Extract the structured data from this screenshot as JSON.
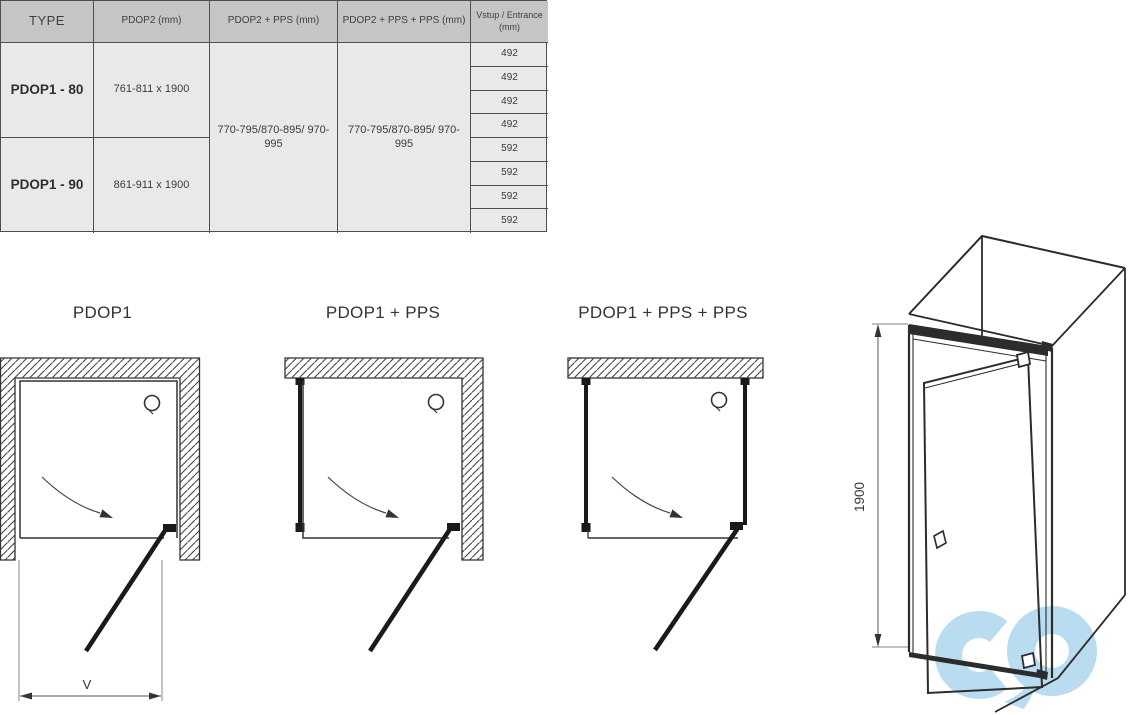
{
  "table": {
    "headers": {
      "type": "TYPE",
      "pdop2": "PDOP2 (mm)",
      "pdop2_pps": "PDOP2 + PPS (mm)",
      "pdop2_pps_pps": "PDOP2 + PPS + PPS (mm)",
      "entrance": "Vstup / Entrance (mm)"
    },
    "rows": [
      {
        "type": "PDOP1 - 80",
        "pdop2_dim": "761-811 x 1900"
      },
      {
        "type": "PDOP1 - 90",
        "pdop2_dim": "861-911 x 1900"
      }
    ],
    "pps_merged_1": "770-795/870-895/ 970-995",
    "pps_merged_2": "770-795/870-895/ 970-995",
    "entrance_values": [
      "492",
      "492",
      "492",
      "492",
      "592",
      "592",
      "592",
      "592"
    ]
  },
  "diagrams": [
    {
      "title": "PDOP1",
      "dimension_label": "V"
    },
    {
      "title": "PDOP1 + PPS"
    },
    {
      "title": "PDOP1 + PPS + PPS"
    }
  ],
  "iso_view": {
    "height_dimension": "1900"
  },
  "logo": {
    "letters": "cd",
    "color": "#b9dcf0"
  },
  "colors": {
    "table_header_bg": "#c5c5c5",
    "table_body_bg": "#e9e9e9",
    "table_border": "#4f4f4f",
    "line": "#2c2c2c",
    "logo_blue": "#b9dcf0"
  }
}
